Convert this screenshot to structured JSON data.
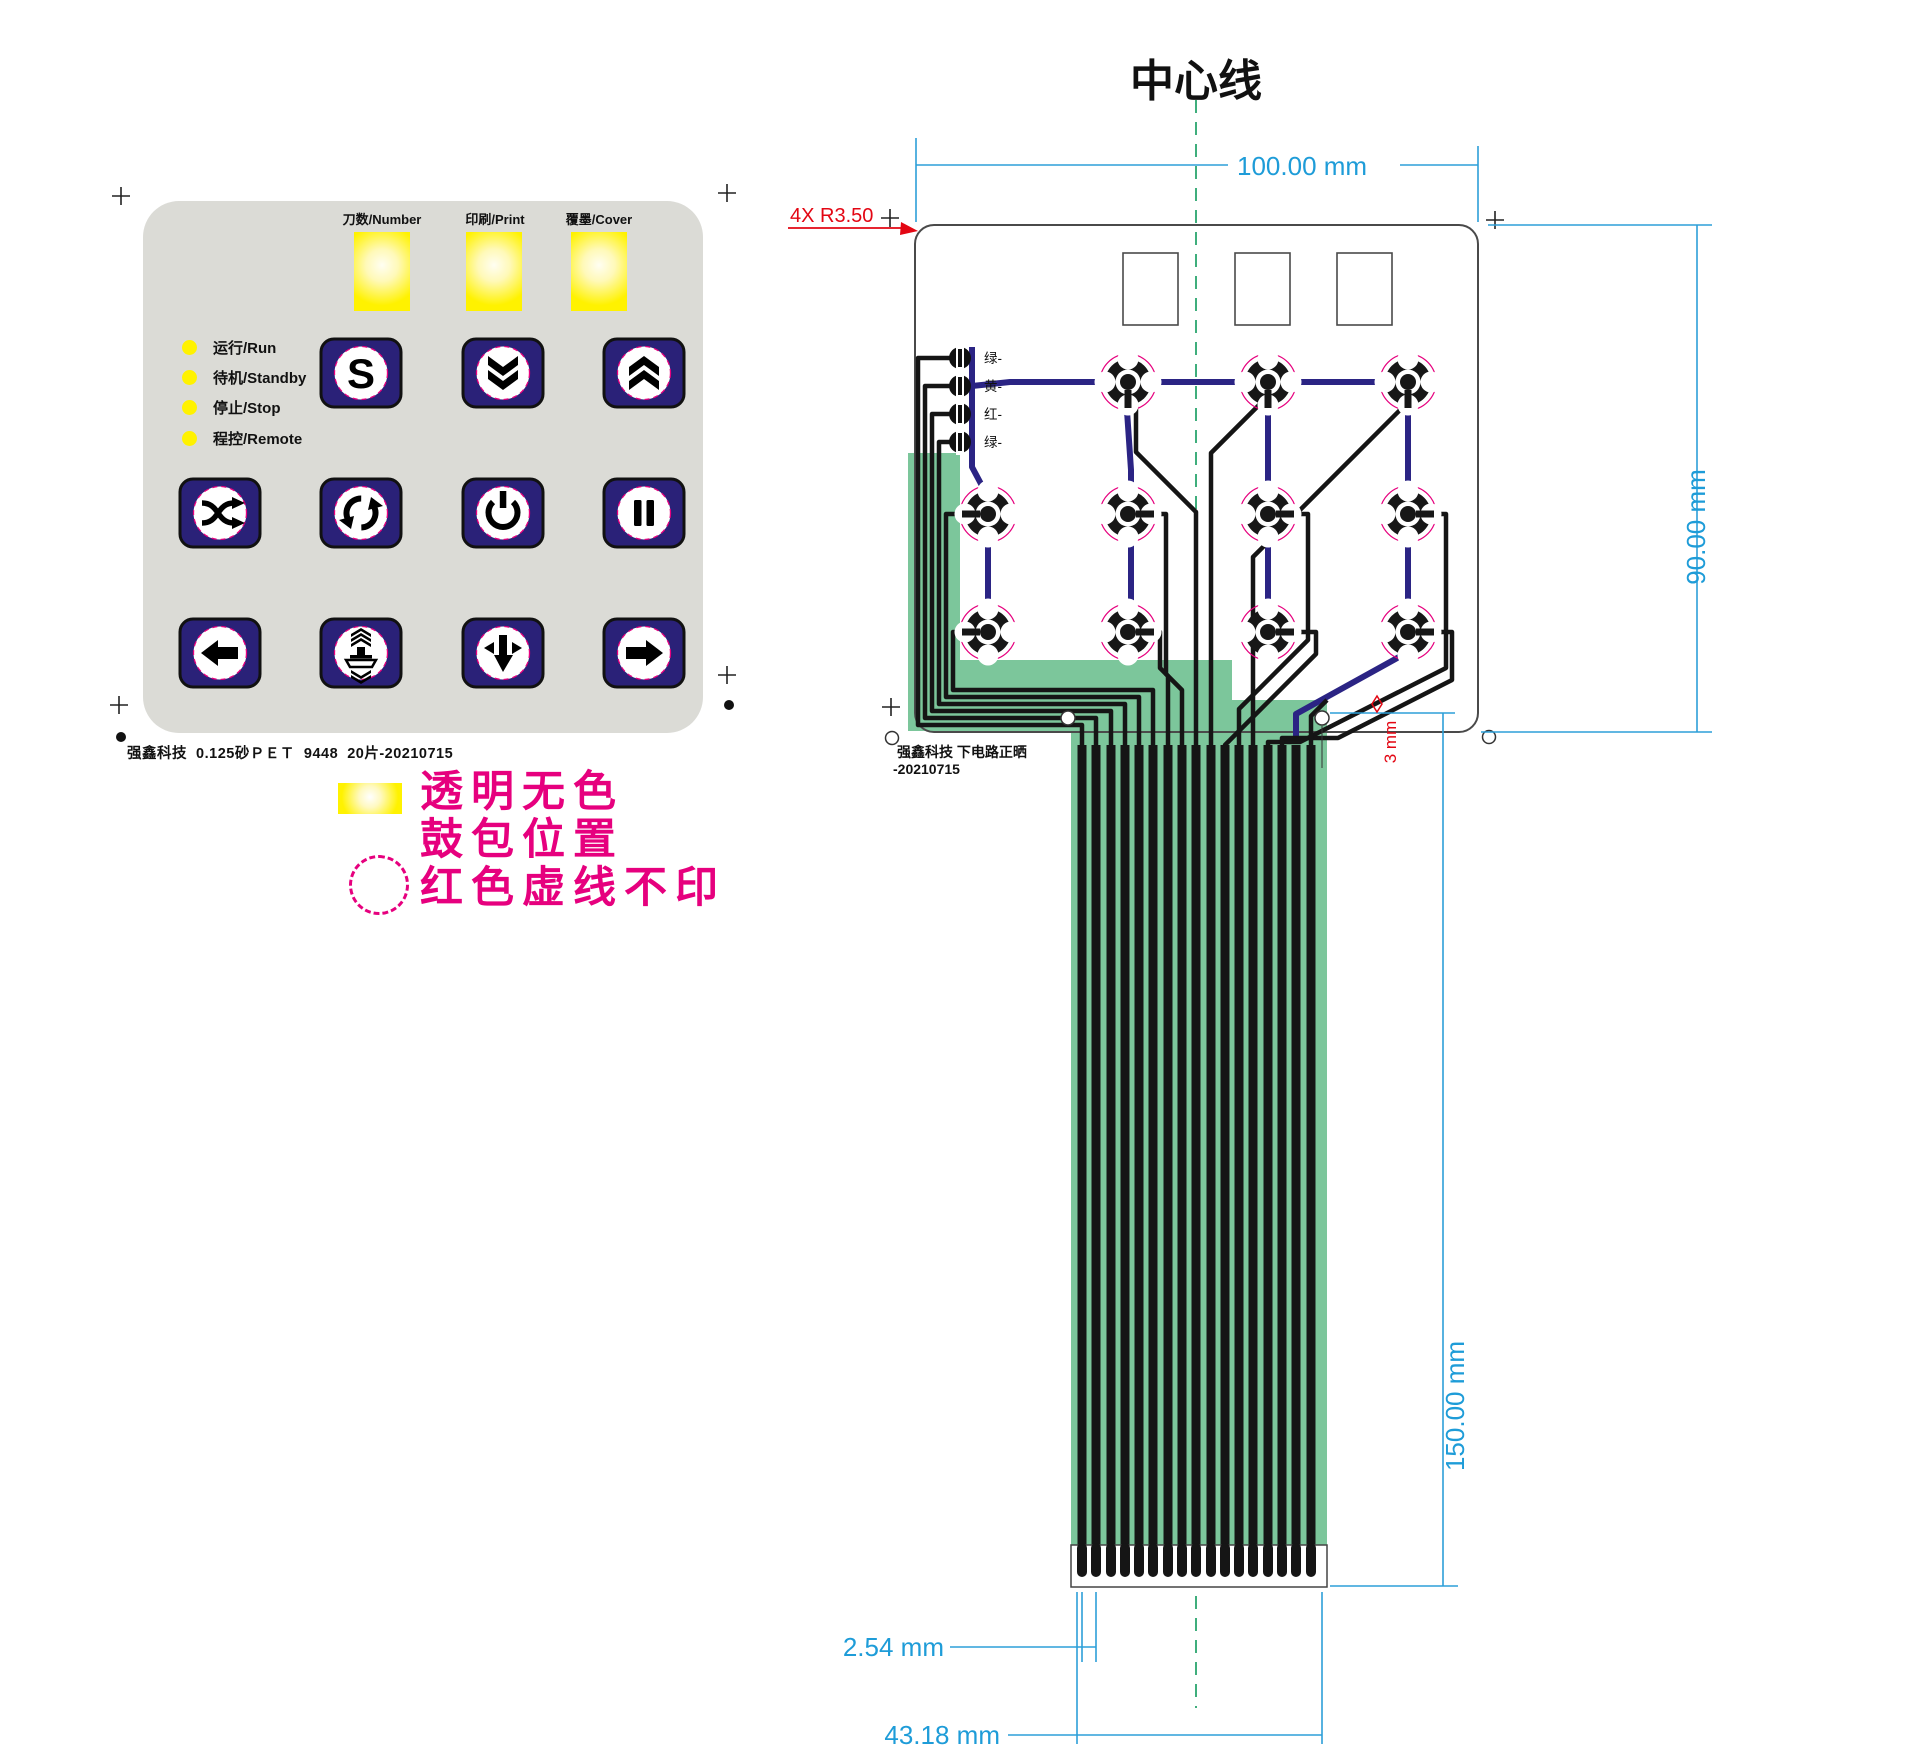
{
  "panel": {
    "windows": [
      {
        "label": "刀数/Number"
      },
      {
        "label": "印刷/Print"
      },
      {
        "label": "覆墨/Cover"
      }
    ],
    "leds": [
      {
        "label": "运行/Run"
      },
      {
        "label": "待机/Standby"
      },
      {
        "label": "停止/Stop"
      },
      {
        "label": "程控/Remote"
      }
    ],
    "s_label": "S",
    "caption": "强鑫科技  0.125砂ＰＥＴ  9448  20片-20210715"
  },
  "legend": {
    "line1": "透明无色",
    "line2": "鼓包位置",
    "line3": "红色虚线不印"
  },
  "diagram": {
    "title": "中心线",
    "dim_width": "100.00 mm",
    "dim_height": "90.00 mm",
    "dim_tail": "150.00 mm",
    "dim_pitch": "2.54 mm",
    "dim_connector": "43.18 mm",
    "corner_note": "4X R3.50",
    "hole_note": "3 mm",
    "led_labels": {
      "l1": "绿-",
      "l2": "黄-",
      "l3": "红-",
      "l4": "绿-"
    },
    "note_line1": "强鑫科技  下电路正晒",
    "note_line2": "-20210715"
  },
  "colors": {
    "panel_gray": "#DBDBD6",
    "window_yellow": "#FFF200",
    "button_navy": "#2A2178",
    "trace_navy": "#2B2484",
    "flex_green": "#7CC69B",
    "centerline_green": "#3FAE7C",
    "dimension_blue": "#1E9CD8",
    "annotation_red": "#E30613",
    "legend_magenta": "#E6007E"
  }
}
